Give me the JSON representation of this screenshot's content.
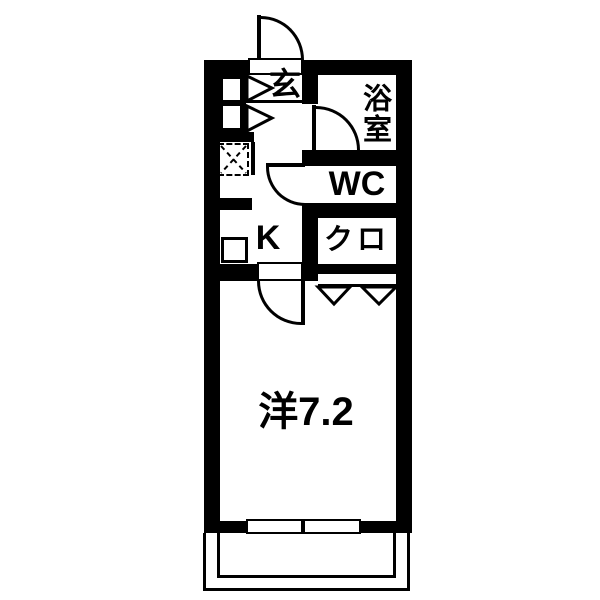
{
  "colors": {
    "line": "#000000",
    "background": "#ffffff"
  },
  "rooms": {
    "entrance": {
      "label": "玄"
    },
    "bathroom": {
      "label": "浴室"
    },
    "toilet": {
      "label": "WC"
    },
    "closet": {
      "label": "クロ"
    },
    "kitchen": {
      "label": "K"
    },
    "main_room": {
      "label": "洋7.2"
    }
  }
}
